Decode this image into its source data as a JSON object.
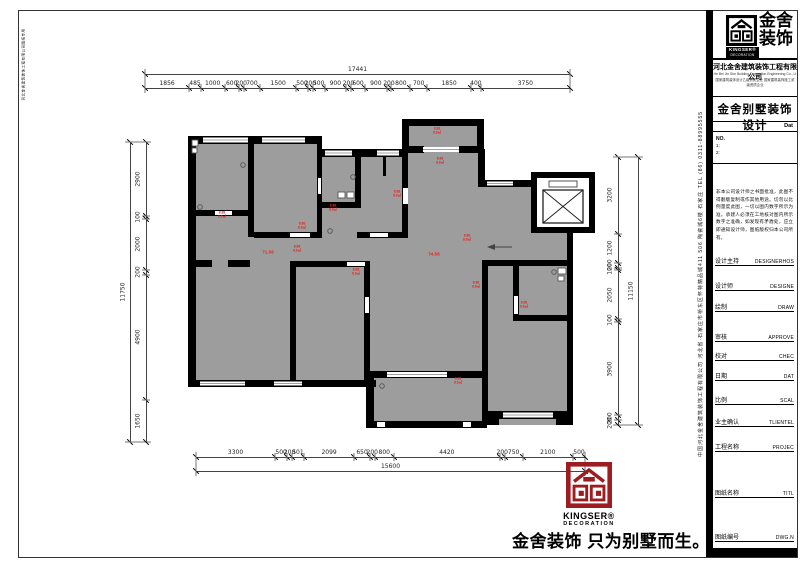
{
  "header_logo": {
    "brand_top": "金舍",
    "brand_bottom": "装饰",
    "kingser": "KINGSER®",
    "decoration": "DECORATION"
  },
  "sidebar": {
    "vertical_address": "中国河北金舍建筑装饰工程有限公司  河北省·石家庄市桥东区怀特精品城411 506 陶瓷城6楼  石家庄  TEL (86) 0311-88995555",
    "company": "河北金舍建筑装饰工程有限公司",
    "company_en": "He Bei Jin She Building Decoration Engineering Co., Lt",
    "company_sub": "国家建筑装饰设计乙级资质企业 国家建筑装饰施工贰级资质企业",
    "doc_title": "金舍别墅装饰设计",
    "date_label": "Dat",
    "no_label": "NO.",
    "no_line1": "1:",
    "no_line2": "2:",
    "disclaimer": "非本公司设计师之书面批准，此图不得翻版复制或作其他用途。切勿以比例量度此图，一切以图内数字所示为准。承建人必须在工地核对图内所示数字之准确，如发现有矛盾处，应立即通知设计师，图纸版权归本公司所有。",
    "rows": [
      {
        "label": "设计主持",
        "value": "DESIGNERHOS"
      },
      {
        "label": "设计师",
        "value": "DESIGNE"
      },
      {
        "label": "绘制",
        "value": "DRAW"
      },
      {
        "label": "审核",
        "value": "APPROVE"
      },
      {
        "label": "校对",
        "value": "CHEC"
      },
      {
        "label": "日期",
        "value": "DAT"
      },
      {
        "label": "比例",
        "value": "SCAL"
      },
      {
        "label": "业主确认",
        "value": "TLIENTEL"
      },
      {
        "label": "工程名称",
        "value": "PROJEC"
      },
      {
        "label": "图纸名称",
        "value": "TITL"
      },
      {
        "label": "图纸编号",
        "value": "DWG.N"
      }
    ]
  },
  "dimensions": {
    "top": {
      "overall": "17441",
      "segments": [
        1856,
        485,
        1000,
        600,
        200,
        700,
        1500,
        500,
        200,
        500,
        900,
        200,
        600,
        900,
        200,
        800,
        700,
        1850,
        400,
        3750
      ]
    },
    "bottom": {
      "overall": "15600",
      "segments": [
        3300,
        500,
        200,
        501,
        2099,
        650,
        200,
        800,
        4420,
        200,
        750,
        2100,
        500
      ]
    },
    "left": {
      "overall": "11750",
      "segments": [
        2900,
        100,
        2000,
        200,
        4900,
        1650
      ]
    },
    "right": {
      "overall": "11150",
      "segments": [
        3200,
        1200,
        200,
        100,
        2050,
        100,
        3900,
        200,
        200
      ]
    }
  },
  "plan": {
    "room_labels": [
      {
        "x": 222,
        "y": 215,
        "l1": "8.88",
        "l2": "8.8㎡"
      },
      {
        "x": 302,
        "y": 226,
        "l1": "8.88",
        "l2": "8.8㎡"
      },
      {
        "x": 297,
        "y": 249,
        "l1": "8.88",
        "l2": "8.8㎡"
      },
      {
        "x": 268,
        "y": 252,
        "big": true,
        "l1": "71.56"
      },
      {
        "x": 333,
        "y": 208,
        "l1": "8.88",
        "l2": "8.8㎡"
      },
      {
        "x": 356,
        "y": 272,
        "l1": "8.88",
        "l2": "8.8㎡"
      },
      {
        "x": 397,
        "y": 194,
        "l1": "8.88",
        "l2": "8.8㎡"
      },
      {
        "x": 440,
        "y": 161,
        "l1": "8.88",
        "l2": "8.8㎡"
      },
      {
        "x": 437,
        "y": 131,
        "l1": "8.88",
        "l2": "8.8㎡"
      },
      {
        "x": 434,
        "y": 254,
        "big": true,
        "l1": "74.56"
      },
      {
        "x": 467,
        "y": 238,
        "l1": "8.88",
        "l2": "8.8㎡"
      },
      {
        "x": 476,
        "y": 285,
        "l1": "8.88",
        "l2": "8.8㎡"
      },
      {
        "x": 458,
        "y": 381,
        "l1": "8.88",
        "l2": "8.8㎡"
      },
      {
        "x": 524,
        "y": 305,
        "l1": "8.88",
        "l2": "8.8㎡"
      }
    ]
  },
  "footer": {
    "kingser": "KINGSER®",
    "decoration": "DECORATION",
    "slogan": "金舍装饰 只为别墅而生。"
  },
  "edge_note": "河北金舍建筑装饰工程有限公司图纸专用",
  "colors": {
    "accent_red": "#9e1c20",
    "label_red": "#e8251f",
    "room_gray": "#9d9d9d",
    "wall": "#000000"
  }
}
